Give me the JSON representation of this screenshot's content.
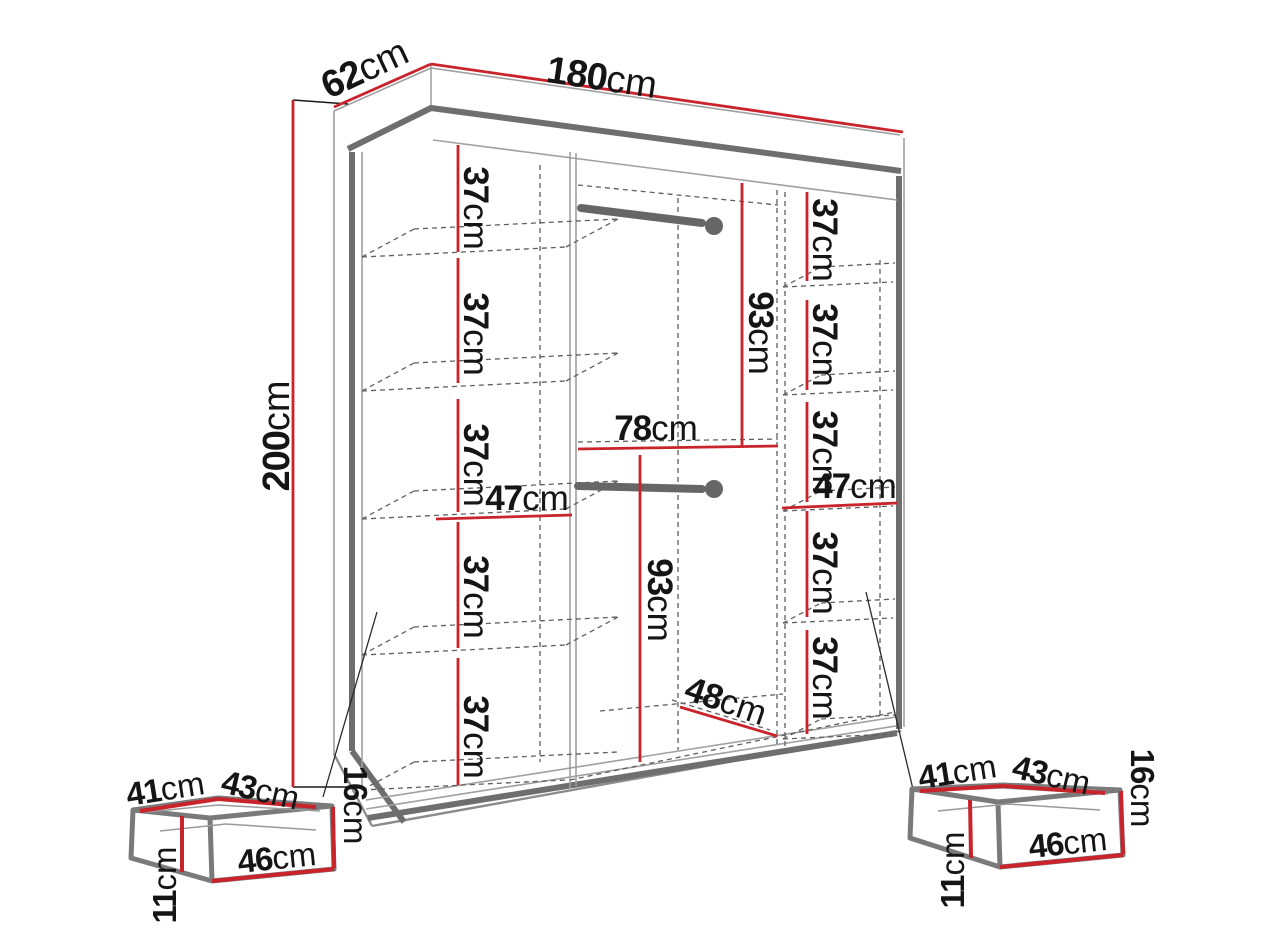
{
  "meta": {
    "title": "Wardrobe dimension diagram",
    "unit": "cm",
    "style": "technical perspective line drawing with red dimension lines"
  },
  "colors": {
    "dimension_line": "#c9232b",
    "outline_gray": "#6e6e6e",
    "dashed_gray": "#5f5f5f",
    "label_text": "#151515",
    "background": "#ffffff"
  },
  "wardrobe": {
    "width": {
      "num": "180",
      "unit": "cm"
    },
    "depth": {
      "num": "62",
      "unit": "cm"
    },
    "height": {
      "num": "200",
      "unit": "cm"
    },
    "left_column": {
      "shelf_gap": {
        "num": "37",
        "unit": "cm"
      },
      "shelf_gaps_cm": [
        37,
        37,
        37,
        37,
        37
      ],
      "section_width": {
        "num": "47",
        "unit": "cm"
      }
    },
    "right_column": {
      "shelf_gap": {
        "num": "37",
        "unit": "cm"
      },
      "shelf_gaps_cm": [
        37,
        37,
        37,
        37,
        37
      ],
      "section_width": {
        "num": "47",
        "unit": "cm"
      }
    },
    "middle_column": {
      "width": {
        "num": "78",
        "unit": "cm"
      },
      "top_hanging_height": {
        "num": "93",
        "unit": "cm"
      },
      "bottom_hanging_height": {
        "num": "93",
        "unit": "cm"
      },
      "bottom_depth": {
        "num": "48",
        "unit": "cm"
      },
      "hanging_rail_count": 2
    }
  },
  "drawer": {
    "count": 2,
    "inner_width": {
      "num": "41",
      "unit": "cm"
    },
    "depth": {
      "num": "43",
      "unit": "cm"
    },
    "front_width": {
      "num": "46",
      "unit": "cm"
    },
    "height": {
      "num": "16",
      "unit": "cm"
    },
    "inner_height": {
      "num": "11",
      "unit": "cm"
    }
  }
}
